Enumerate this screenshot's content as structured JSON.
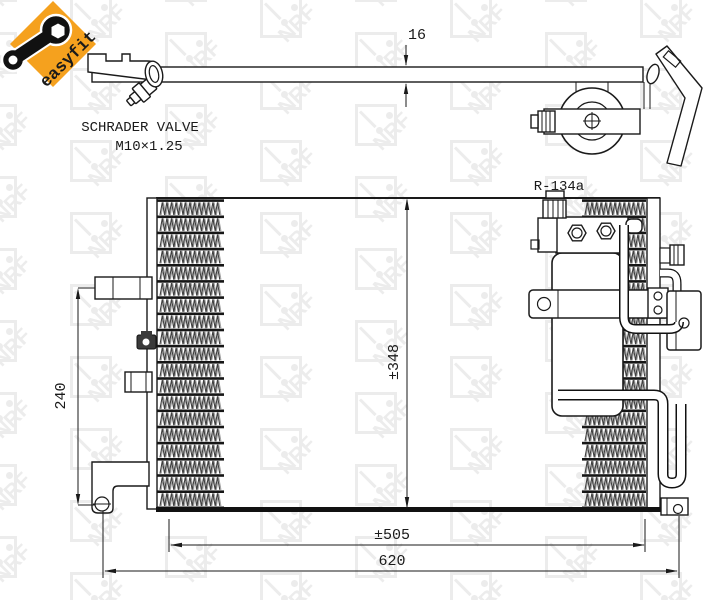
{
  "badge": {
    "label": "easyfit",
    "bg_color": "#F5A11E",
    "text_color": "#111111"
  },
  "annotations": {
    "valve_label_line1": "SCHRADER VALVE",
    "valve_label_line2": "M10×1.25",
    "refrigerant_label": "R-134a"
  },
  "dimensions": {
    "core_thickness": "16",
    "bracket_spacing": "240",
    "core_height": "±348",
    "core_width": "±505",
    "overall_width": "620"
  },
  "watermark": {
    "text": "NRF",
    "color": "#ececec"
  },
  "drawing": {
    "line_color": "#1a1a1a"
  }
}
